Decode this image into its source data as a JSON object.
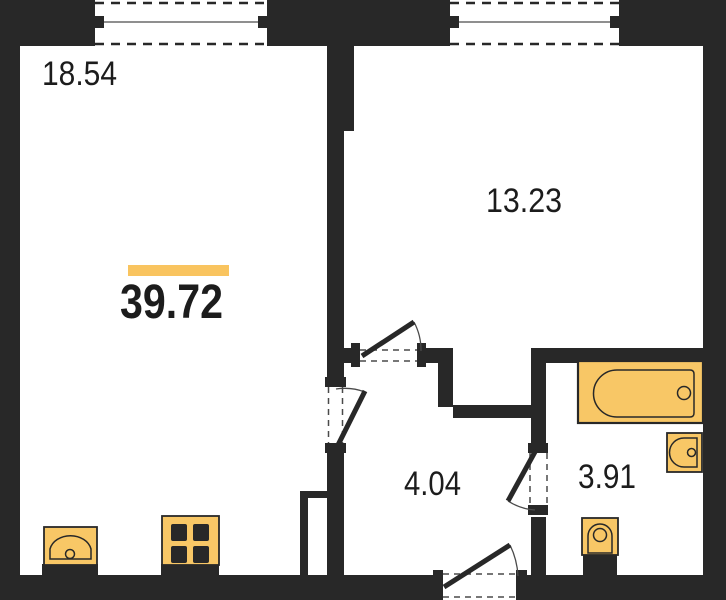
{
  "plan": {
    "title": "apartment-floor-plan",
    "total": {
      "area": "39.72"
    },
    "rooms": [
      {
        "id": "living-kitchen",
        "area": "18.54"
      },
      {
        "id": "bedroom",
        "area": "13.23"
      },
      {
        "id": "hallway",
        "area": "4.04"
      },
      {
        "id": "bathroom",
        "area": "3.91"
      }
    ],
    "fixtures": [
      "bathtub",
      "wall-sink",
      "toilet",
      "kitchen-sink",
      "stove"
    ],
    "openings": {
      "windows": 2,
      "doors": 4
    }
  },
  "colors": {
    "wall": "#282828",
    "fixture": "#F8C766",
    "accent_bar": "#F9C45F",
    "text": "#1C1C1C",
    "line": "#4A4A4A",
    "background": "#FFFFFF"
  }
}
